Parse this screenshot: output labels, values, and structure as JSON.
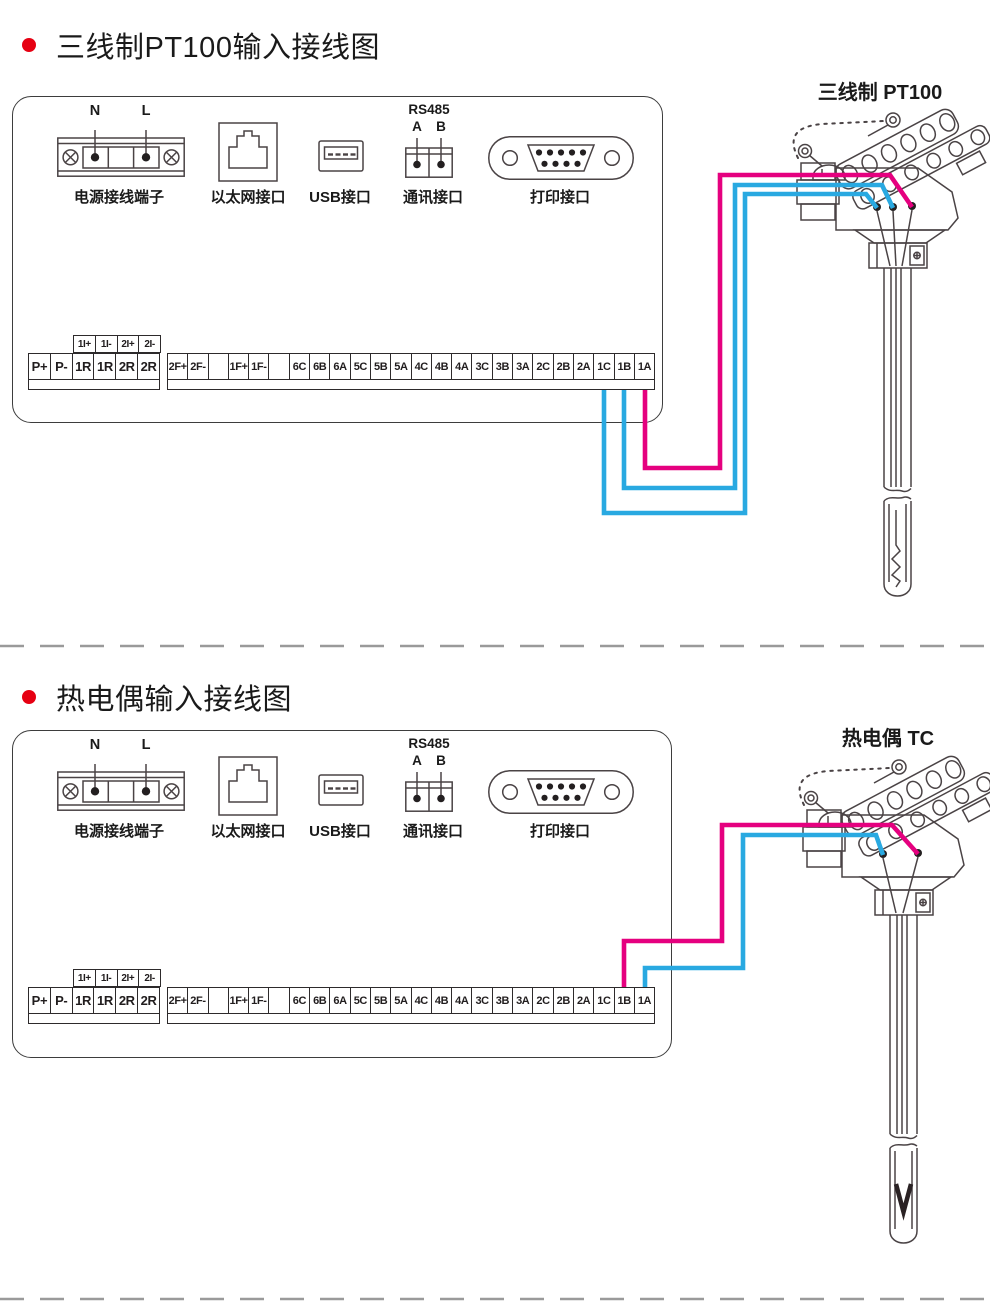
{
  "colors": {
    "wire_pink": "#e5007f",
    "wire_blue": "#29a9e1",
    "bullet_red": "#e60012"
  },
  "sections": [
    {
      "title": "三线制PT100输入接线图",
      "sensor_label": "三线制 PT100"
    },
    {
      "title": "热电偶输入接线图",
      "sensor_label": "热电偶 TC"
    }
  ],
  "panel": {
    "power": {
      "label": "电源接线端子",
      "n": "N",
      "l": "L"
    },
    "ethernet": {
      "label": "以太网接口"
    },
    "usb": {
      "label": "USB接口"
    },
    "rs485": {
      "label": "通讯接口",
      "bus": "RS485",
      "a": "A",
      "b": "B"
    },
    "printer": {
      "label": "打印接口"
    },
    "terminals": {
      "current_row": [
        "1I+",
        "1I-",
        "2I+",
        "2I-"
      ],
      "relay_row": [
        "P+",
        "P-",
        "1R",
        "1R",
        "2R",
        "2R"
      ],
      "main_row": [
        "2F+",
        "2F-",
        "",
        "1F+",
        "1F-",
        "",
        "6C",
        "6B",
        "6A",
        "5C",
        "5B",
        "5A",
        "4C",
        "4B",
        "4A",
        "3C",
        "3B",
        "3A",
        "2C",
        "2B",
        "2A",
        "1C",
        "1B",
        "1A"
      ]
    }
  },
  "icons": {
    "power_terminal": "power-terminal-icon",
    "ethernet_port": "ethernet-port-icon",
    "usb_port": "usb-port-icon",
    "rs485_port": "rs485-port-icon",
    "printer_port": "db9-printer-port-icon",
    "sensor": "temperature-probe-icon"
  }
}
